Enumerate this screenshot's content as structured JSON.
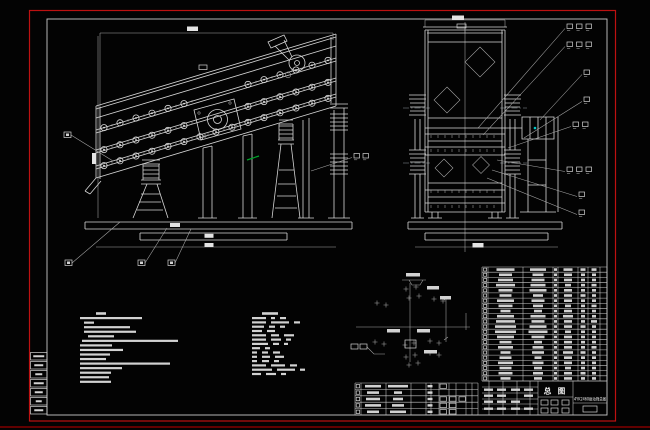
{
  "window": {
    "kind": "cad-assembly-drawing",
    "sheet_bg": "#030303",
    "border_color": "#bd1111",
    "frame_color": "#c9c9c9",
    "line_color": "#d6d6d6",
    "accent_green": "#00a32a",
    "accent_cyan": "#00c8c8"
  },
  "title_block": {
    "view_label": "总 图",
    "drawing_title": "4YK2460振动筛总图",
    "signature_blobs": [
      [
        484,
        388.5
      ],
      [
        497,
        388.5
      ],
      [
        511,
        388.5
      ],
      [
        524,
        388.5
      ],
      [
        484,
        394.5
      ],
      [
        497,
        394.5
      ],
      [
        524,
        394.5
      ],
      [
        484,
        400.5
      ],
      [
        497,
        400.5
      ],
      [
        511,
        400.5
      ],
      [
        484,
        407.5
      ],
      [
        497,
        407.5
      ],
      [
        511,
        407.5
      ],
      [
        524,
        407.5
      ]
    ],
    "small_boxes": [
      [
        541,
        400,
        7,
        5
      ],
      [
        551,
        400,
        7,
        5
      ],
      [
        541,
        408,
        7,
        5
      ],
      [
        551,
        408,
        7,
        5
      ],
      [
        562,
        400,
        7,
        5
      ],
      [
        562,
        408,
        7,
        5
      ]
    ],
    "scale_box": [
      583,
      406,
      14,
      6
    ]
  },
  "bom_table": {
    "x_cols": [
      482,
      488,
      523,
      553,
      558,
      578,
      588,
      600,
      607
    ],
    "y_top": 267,
    "row_h": 5.1818,
    "col_centers": {
      "code": 505.5,
      "name": 538,
      "qty": 555.5,
      "mat": 568,
      "wt1": 583,
      "wt2": 594
    },
    "rows": [
      [
        18,
        16,
        3,
        9,
        5,
        5
      ],
      [
        13,
        11,
        3,
        8,
        4,
        4
      ],
      [
        15,
        13,
        3,
        8,
        4,
        4
      ],
      [
        19,
        15,
        3,
        6,
        4,
        5
      ],
      [
        14,
        17,
        3,
        8,
        4,
        4
      ],
      [
        12,
        10,
        3,
        8,
        5,
        4
      ],
      [
        17,
        13,
        3,
        8,
        4,
        4
      ],
      [
        14,
        10,
        3,
        6,
        4,
        5
      ],
      [
        10,
        8,
        3,
        8,
        4,
        4
      ],
      [
        17,
        15,
        3,
        10,
        4,
        4
      ],
      [
        19,
        13,
        3,
        8,
        4,
        6
      ],
      [
        21,
        17,
        3,
        8,
        5,
        4
      ],
      [
        21,
        19,
        3,
        6,
        4,
        4
      ],
      [
        17,
        13,
        3,
        8,
        4,
        4
      ],
      [
        12,
        8,
        3,
        8,
        4,
        4
      ],
      [
        15,
        11,
        3,
        8,
        4,
        5
      ],
      [
        10,
        12,
        3,
        10,
        5,
        4
      ],
      [
        12,
        7,
        3,
        8,
        4,
        4
      ],
      [
        15,
        11,
        3,
        8,
        4,
        4
      ],
      [
        12,
        8,
        3,
        6,
        4,
        4
      ],
      [
        14,
        10,
        3,
        8,
        5,
        4
      ],
      [
        10,
        8,
        3,
        8,
        4,
        4
      ]
    ]
  },
  "lower_table": {
    "x_cols": [
      355,
      361,
      386,
      411,
      426,
      431,
      439,
      449,
      456,
      466,
      472,
      478
    ],
    "y_top": 383,
    "row_h": 6.4,
    "c1_center": 373,
    "c2_center": 398,
    "rows": [
      [
        16,
        20,
        1
      ],
      [
        12,
        8,
        0
      ],
      [
        14,
        10,
        3
      ],
      [
        16,
        12,
        2
      ],
      [
        12,
        16,
        2
      ]
    ]
  },
  "notes": {
    "left": {
      "y0": 317,
      "dy": 4.55,
      "title": [
        96,
        312.2,
        10
      ],
      "lines": [
        [
          80,
          62
        ],
        [
          84,
          10
        ],
        [
          84,
          46
        ],
        [
          84,
          52
        ],
        [
          88,
          26
        ],
        [
          82,
          96
        ],
        [
          80,
          32
        ],
        [
          80,
          43
        ],
        [
          80,
          30
        ],
        [
          80,
          26
        ],
        [
          80,
          90
        ],
        [
          80,
          42
        ],
        [
          80,
          31
        ],
        [
          80,
          29
        ],
        [
          80,
          31
        ]
      ]
    },
    "right": {
      "x": 252,
      "y0": 317,
      "dy": 4.3,
      "title": [
        262,
        312.2,
        16
      ],
      "lines": [
        [
          14,
          4,
          6
        ],
        [
          14,
          18,
          6
        ],
        [
          12,
          6,
          5
        ],
        [
          10,
          8
        ],
        [
          14,
          8,
          10
        ],
        [
          14,
          10,
          5
        ],
        [
          16,
          6,
          4
        ],
        [
          8,
          5
        ],
        [
          5,
          6,
          7
        ],
        [
          5,
          8,
          9
        ],
        [
          5,
          7,
          5
        ],
        [
          14,
          14,
          7
        ],
        [
          20,
          18,
          5
        ],
        [
          9,
          10,
          5
        ]
      ]
    }
  },
  "part_labels_right": [
    {
      "n": 3,
      "x": 567,
      "y": 24,
      "ox": 478,
      "oy": 128
    },
    {
      "n": 3,
      "x": 567,
      "y": 42,
      "ox": 483,
      "oy": 135
    },
    {
      "n": 1,
      "x": 584,
      "y": 70,
      "ox": 540,
      "oy": 120
    },
    {
      "n": 1,
      "x": 584,
      "y": 97,
      "ox": 524,
      "oy": 138
    },
    {
      "n": 2,
      "x": 573,
      "y": 122,
      "ox": 508,
      "oy": 148
    },
    {
      "n": 3,
      "x": 567,
      "y": 167,
      "ox": 497,
      "oy": 160
    },
    {
      "n": 1,
      "x": 579,
      "y": 192,
      "ox": 492,
      "oy": 170
    },
    {
      "n": 1,
      "x": 579,
      "y": 210,
      "ox": 487,
      "oy": 178
    }
  ],
  "part_labels_mid": {
    "boxes": [
      [
        354,
        153.5
      ],
      [
        363,
        153.5
      ]
    ],
    "leader": [
      311,
      171,
      352,
      157.5
    ]
  },
  "balloons": [
    {
      "x": 64,
      "y": 132,
      "lx": 113,
      "ly": 161
    },
    {
      "x": 65,
      "y": 260,
      "lx": 120,
      "ly": 222
    },
    {
      "x": 138,
      "y": 260,
      "lx": 167,
      "ly": 228
    },
    {
      "x": 168,
      "y": 260,
      "lx": 191,
      "ly": 229
    }
  ],
  "revision_strip": {
    "x": 30.5,
    "w": 16.5,
    "h": 7.5,
    "ys": [
      352.5,
      361.5,
      370.5,
      379.5,
      388.5,
      397.5,
      406.5
    ],
    "marks": [
      11,
      9,
      7,
      10,
      8,
      6,
      9
    ]
  },
  "deck_bolts": {
    "x0": 104,
    "x1": 332,
    "step": 16,
    "base_x": 96,
    "base_y": 106,
    "slope": -0.3,
    "offsets": [
      24,
      46,
      62
    ],
    "radius": 3.1
  },
  "end_ticks": {
    "rows": [
      136.5,
      150.5,
      191.5,
      206.5
    ],
    "x0": 431,
    "x1": 499,
    "step": 7
  },
  "dim_blobs": [
    [
      187,
      26.5,
      11,
      4.5
    ],
    [
      92,
      153,
      4,
      11
    ],
    [
      170,
      223,
      10,
      4
    ],
    [
      204.5,
      233.8,
      9,
      4
    ],
    [
      204.5,
      243,
      9,
      4
    ],
    [
      452,
      15.5,
      12,
      4.5
    ],
    [
      472.5,
      243,
      11,
      4.5
    ]
  ],
  "detail": {
    "crosses": [
      [
        406,
        289
      ],
      [
        416,
        287
      ],
      [
        409,
        298
      ],
      [
        419,
        296
      ],
      [
        377,
        303
      ],
      [
        386,
        305
      ],
      [
        434,
        299
      ],
      [
        443,
        301
      ],
      [
        375,
        342
      ],
      [
        384,
        344
      ],
      [
        430,
        341
      ],
      [
        439,
        343
      ],
      [
        430,
        353
      ],
      [
        439,
        355
      ],
      [
        405,
        345
      ],
      [
        414,
        343
      ],
      [
        406,
        357
      ],
      [
        415,
        355
      ],
      [
        409,
        365
      ],
      [
        418,
        363
      ]
    ],
    "pads": [
      [
        387,
        329,
        13,
        3.5
      ],
      [
        417,
        329,
        13,
        3.5
      ],
      [
        440,
        296,
        11,
        3.5
      ],
      [
        424,
        350,
        13,
        3.5
      ],
      [
        406,
        273,
        14,
        3.5
      ],
      [
        427,
        286,
        12,
        3.5
      ]
    ],
    "boxes": [
      [
        405,
        340,
        11,
        8
      ],
      [
        351,
        344,
        7,
        5
      ],
      [
        360,
        344,
        7,
        5
      ]
    ]
  }
}
